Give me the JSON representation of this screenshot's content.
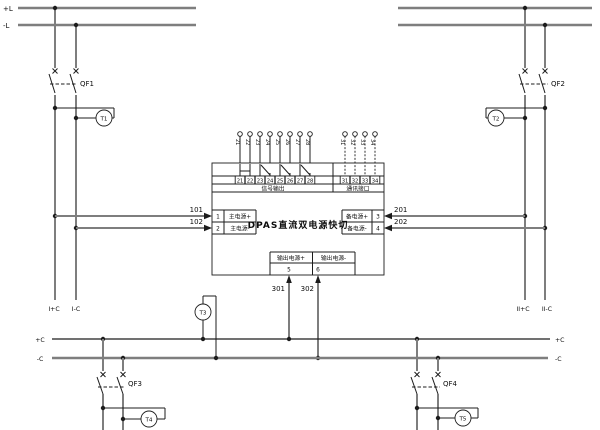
{
  "colors": {
    "wire_gray": "#7e7e7e",
    "line_black": "#1c1c1c",
    "background": "#ffffff"
  },
  "top_buses": {
    "pos_label": "+L",
    "neg_label": "-L"
  },
  "feeder1": {
    "breaker_label": "QF1",
    "relay_label": "T1",
    "tap_pos_wire": "101",
    "tap_neg_wire": "102",
    "drop_pos_label": "I+C",
    "drop_neg_label": "I-C"
  },
  "feeder2": {
    "breaker_label": "QF2",
    "relay_label": "T2",
    "tap_pos_wire": "201",
    "tap_neg_wire": "202",
    "drop_pos_label": "II+C",
    "drop_neg_label": "II-C"
  },
  "device": {
    "title": "DPAS直流双电源快切",
    "signal_section": {
      "label": "信号输出",
      "wire_labels": [
        "21",
        "22",
        "23",
        "24",
        "25",
        "26",
        "27",
        "28"
      ],
      "terminals": [
        "21",
        "22",
        "23",
        "24",
        "25",
        "26",
        "27",
        "28"
      ]
    },
    "comm_section": {
      "label": "通讯接口",
      "wire_labels": [
        "31",
        "32",
        "33",
        "34"
      ],
      "terminals": [
        "31",
        "32",
        "33",
        "34"
      ]
    },
    "main_input": {
      "t1_no": "1",
      "t1_label": "主电源+",
      "t2_no": "2",
      "t2_label": "主电源-"
    },
    "backup_input": {
      "t3_label": "备电源+",
      "t3_no": "3",
      "t4_label": "备电源-",
      "t4_no": "4"
    },
    "output": {
      "pos_label": "输出电源+",
      "neg_label": "输出电源-",
      "pos_no": "5",
      "neg_no": "6",
      "pos_wire": "301",
      "neg_wire": "302"
    }
  },
  "bottom_buses": {
    "pos_label_left": "+C",
    "neg_label_left": "-C",
    "pos_label_right": "+C",
    "neg_label_right": "-C",
    "relay_label": "T3"
  },
  "feeder3": {
    "breaker_label": "QF3",
    "relay_label": "T4"
  },
  "feeder4": {
    "breaker_label": "QF4",
    "relay_label": "T5"
  }
}
